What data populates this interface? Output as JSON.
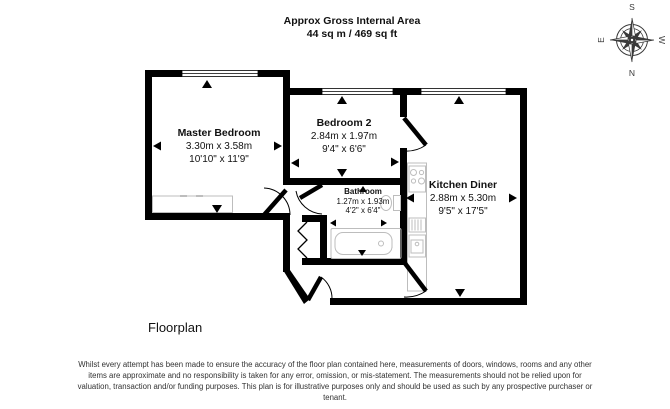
{
  "header": {
    "title": "Approx Gross Internal Area",
    "area": "44 sq m / 469 sq ft"
  },
  "compass": {
    "top": "S",
    "bottom": "N",
    "left": "E",
    "right": "W"
  },
  "rooms": {
    "master": {
      "name": "Master Bedroom",
      "metric": "3.30m x 3.58m",
      "imperial": "10'10\" x 11'9\""
    },
    "bedroom2": {
      "name": "Bedroom 2",
      "metric": "2.84m x 1.97m",
      "imperial": "9'4\" x 6'6\""
    },
    "bathroom": {
      "name": "Bathroom",
      "metric": "1.27m x 1.93m",
      "imperial": "4'2\" x 6'4\""
    },
    "kitchen": {
      "name": "Kitchen Diner",
      "metric": "2.88m x 5.30m",
      "imperial": "9'5\" x 17'5\""
    }
  },
  "caption": "Floorplan",
  "disclaimer": "Whilst every attempt has been made to ensure the accuracy of the floor plan contained here, measurements of doors, windows, rooms and any other items are approximate and no responsibility is taken for any error, omission, or mis-statement. The measurements should not be relied upon for valuation, transaction and/or funding purposes. This plan is for illustrative purposes only and should be used as such by any prospective purchaser or tenant.",
  "colors": {
    "wall": "#000000",
    "fixture": "#bdbdbd",
    "compass": "#3a3a3a"
  }
}
